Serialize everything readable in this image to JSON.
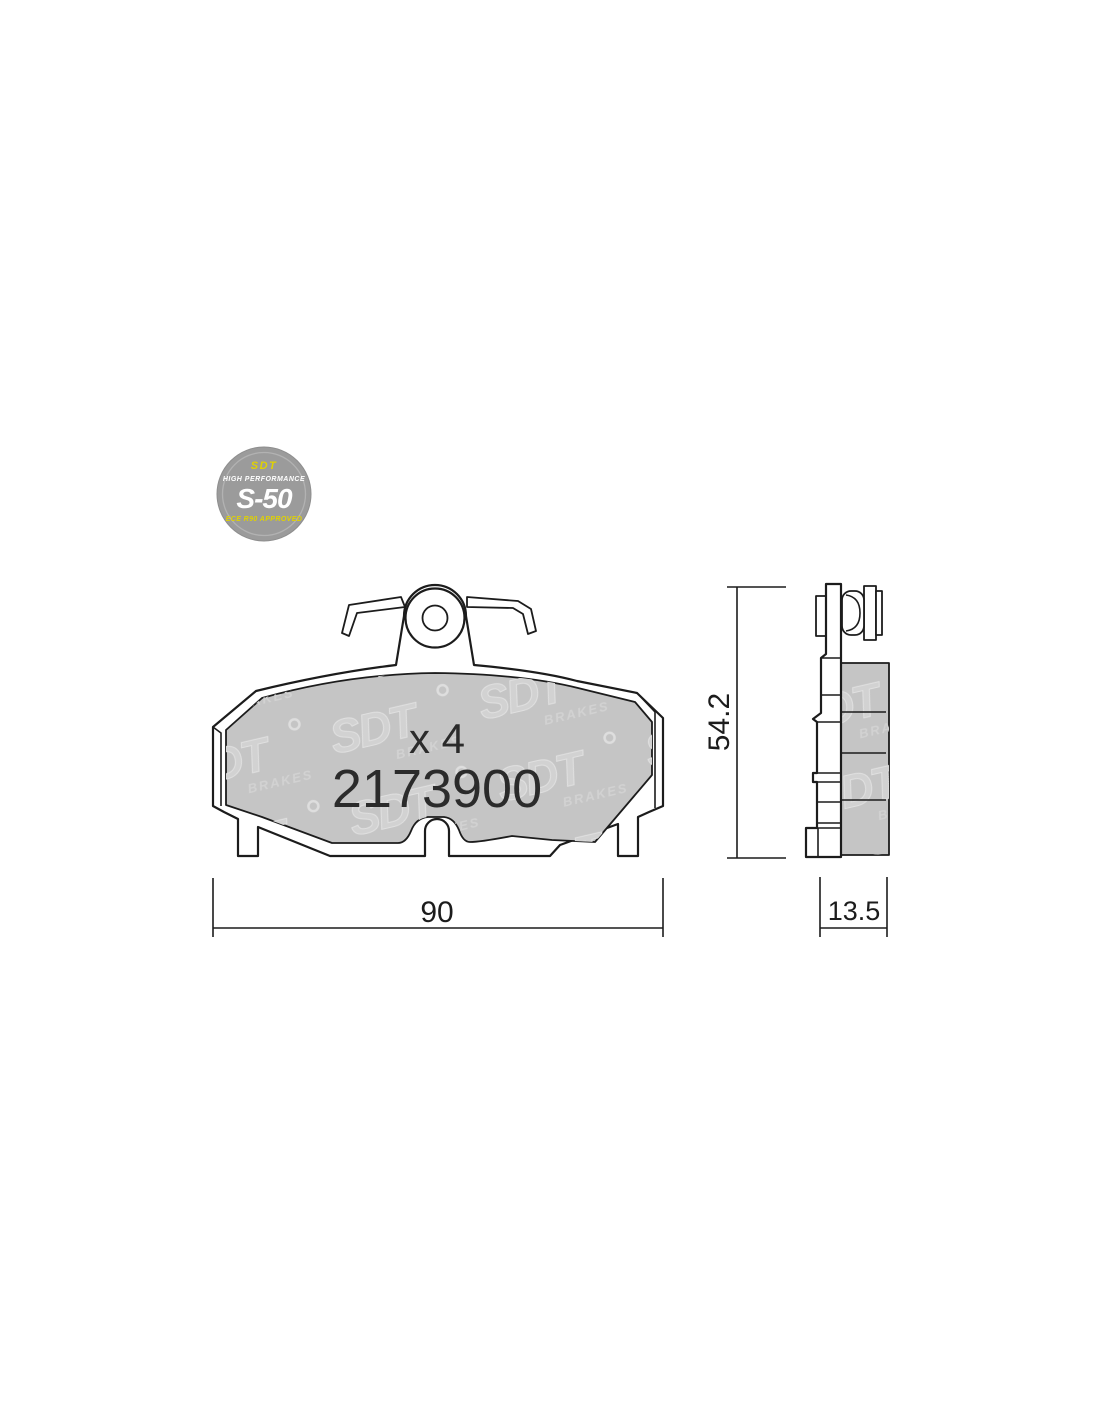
{
  "badge": {
    "brand": "SDT",
    "tagline": "HIGH PERFORMANCE",
    "model": "S-50",
    "approval": "ECE R90 APPROVED"
  },
  "part": {
    "quantity": "x 4",
    "number": "2173900"
  },
  "dimensions": {
    "width": "90",
    "height": "54.2",
    "thickness": "13.5"
  },
  "watermark": {
    "brand": "SDT",
    "sub": "BRAKES"
  },
  "colors": {
    "line": "#1c1c1c",
    "text": "#2b2b2b",
    "friction": "#c5c5c5",
    "watermark_fill": "#d2d2d2",
    "badge_bg": "#9b9b9b",
    "accent_yellow": "#e0d200"
  }
}
